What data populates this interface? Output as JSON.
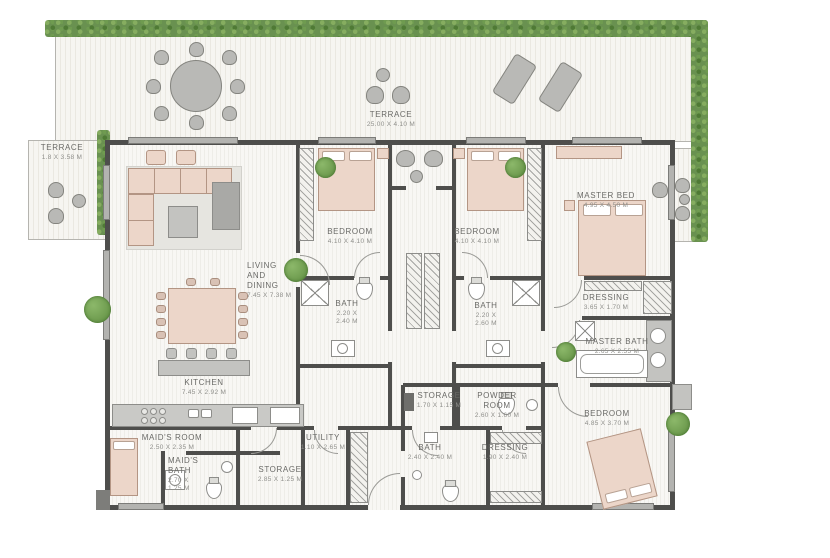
{
  "plan": {
    "type": "residential floor plan",
    "colors": {
      "wall": "#4e4e4c",
      "hedge_green": "#699150",
      "furniture_pink": "#ecd6c9",
      "furniture_gray": "#c3c3c0",
      "label_text": "#6a6a67"
    },
    "rooms": {
      "terrace_top": {
        "name": "TERRACE",
        "dims": "25.00 X 4.10 M"
      },
      "terrace_left": {
        "name": "TERRACE",
        "dims": "1.8 X 3.58 M"
      },
      "living": {
        "name": "LIVING\nAND\nDINING",
        "dims": "7.45 X 7.38 M"
      },
      "bedroom1": {
        "name": "BEDROOM",
        "dims": "4.10 X 4.10 M"
      },
      "bedroom2": {
        "name": "BEDROOM",
        "dims": "4.10 X 4.10 M"
      },
      "master_bed": {
        "name": "MASTER BED",
        "dims": "4.95 X 4.50 M"
      },
      "bath1": {
        "name": "BATH",
        "dims": "2.20 X\n2.40 M"
      },
      "bath2": {
        "name": "BATH",
        "dims": "2.20 X\n2.60 M"
      },
      "dressing_master": {
        "name": "DRESSING",
        "dims": "3.65 X 1.70 M"
      },
      "master_bath": {
        "name": "MASTER BATH",
        "dims": "2.65 X 2.55 M"
      },
      "kitchen": {
        "name": "KITCHEN",
        "dims": "7.45 X 2.92 M"
      },
      "maids_room": {
        "name": "MAID'S ROOM",
        "dims": "2.50 X 2.35 M"
      },
      "maids_bath": {
        "name": "MAID'S\nBATH",
        "dims": "2.70 X\n1.25 M"
      },
      "storage_left": {
        "name": "STORAGE",
        "dims": "2.85 X 1.25 M"
      },
      "utility": {
        "name": "UTILITY",
        "dims": "1.10 X 2.65 M"
      },
      "storage_mid": {
        "name": "STORAGE",
        "dims": "1.70 X 1.15 M"
      },
      "powder": {
        "name": "POWDER\nROOM",
        "dims": "2.60 X 1.60 M"
      },
      "bath3": {
        "name": "BATH",
        "dims": "2.40 X 2.40 M"
      },
      "dressing2": {
        "name": "DRESSING",
        "dims": "1.90 X 2.40 M"
      },
      "bedroom3": {
        "name": "BEDROOM",
        "dims": "4.85 X 3.70 M"
      }
    }
  }
}
